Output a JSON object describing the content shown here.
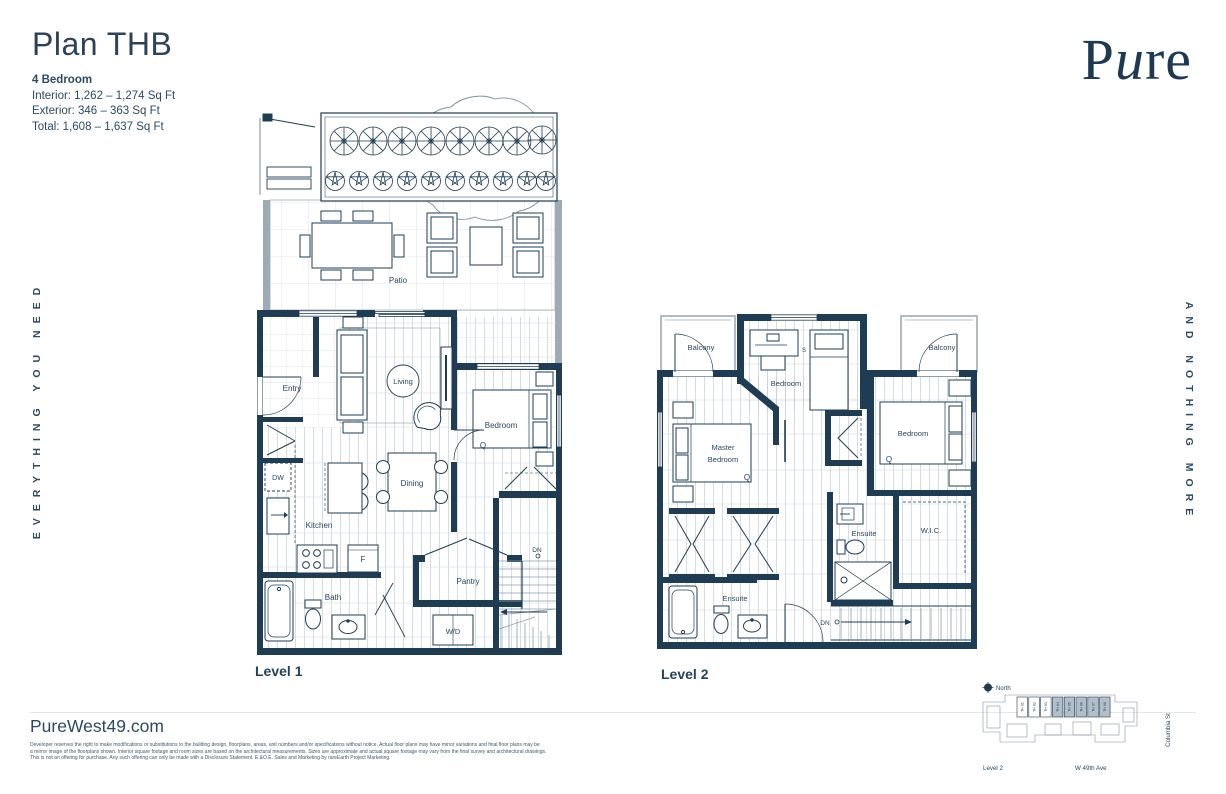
{
  "header": {
    "title": "Plan THB",
    "bedrooms": "4 Bedroom",
    "interior": "Interior: 1,262 – 1,274 Sq Ft",
    "exterior": "Exterior: 346 – 363 Sq Ft",
    "total": "Total:  1,608 – 1,637 Sq Ft"
  },
  "brand": {
    "p": "P",
    "u": "u",
    "re": "re"
  },
  "taglines": {
    "left": "EVERYTHING YOU NEED",
    "right": "AND NOTHING MORE"
  },
  "level1": {
    "name": "Level 1",
    "labels": {
      "patio": "Patio",
      "entry": "Entry",
      "living": "Living",
      "bedroom": "Bedroom",
      "bedroom_size": "Q",
      "dw": "DW",
      "dining": "Dining",
      "kitchen": "Kitchen",
      "fridge": "F",
      "pantry": "Pantry",
      "stairs_dn": "DN",
      "bath": "Bath",
      "washer_dryer": "W/D"
    }
  },
  "level2": {
    "name": "Level 2",
    "labels": {
      "balcony_left": "Balcony",
      "balcony_right": "Balcony",
      "bedroom_top": "Bedroom",
      "bedroom_top_size": "S",
      "master_line1": "Master",
      "master_line2": "Bedroom",
      "master_size": "Q",
      "bedroom_right": "Bedroom",
      "bedroom_right_size": "Q",
      "ensuite_left": "Ensuite",
      "ensuite_right": "Ensuite",
      "wic": "W.I.C.",
      "stairs_dn": "DN"
    }
  },
  "footer": {
    "website": "PureWest49.com",
    "disclaimer": [
      "Developer reserves the right to make modifications or substitutions to the building design, floorplans, areas, unit numbers and/or specifications without notice. Actual floor plans may have minor variations and final floor plans may be",
      "a mirror image of the floorplans shown. Interior square footage and room sizes are based on the architectural measurements. Sizes are approximate and actual square footage may vary from the final survey and architectural drawings.",
      "This is not an offering for purchase. Any such offering can only be made with a Disclosure Statement. E.&O.E. Sales and Marketing by rareEarth Project Marketing."
    ]
  },
  "sitemap": {
    "north": "North",
    "level": "Level 2",
    "street_bottom": "W 49th Ave",
    "street_right": "Columbia St",
    "units": [
      "TH 01",
      "TH 02",
      "TH 03",
      "TH 04",
      "TH 05",
      "TH 06",
      "TH 07",
      "TH 08"
    ]
  },
  "colors": {
    "wall_navy": "#1e3d54",
    "label_navy": "#27465e",
    "gray_wall": "#9fabb4",
    "floor_line": "#c3ced6",
    "unit_shade": "#b3bfc8"
  }
}
